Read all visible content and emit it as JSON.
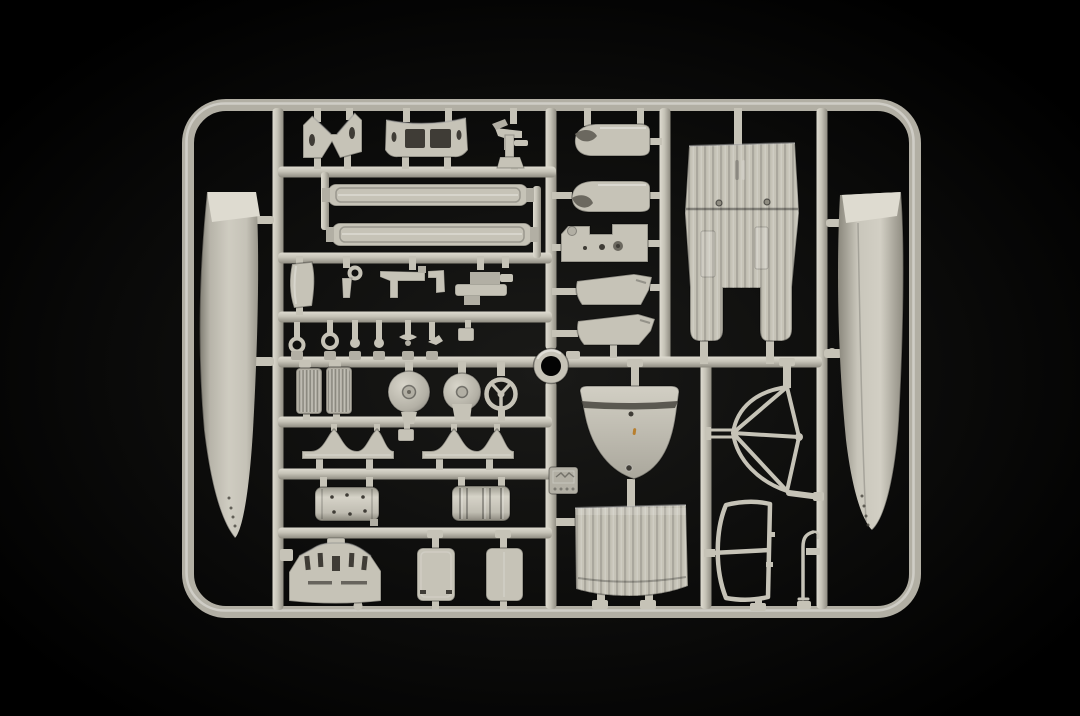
{
  "scene": {
    "media": "photograph",
    "subject": "injection-moulded model kit sprue of light grey aircraft parts on a black studio background"
  },
  "colors": {
    "background": "#000000",
    "glow": "#1a1a18",
    "plastic_base": "#c6c3b7",
    "plastic_light": "#dedbd0",
    "plastic_mid": "#b2afa4",
    "plastic_dark": "#8f8c81",
    "plastic_deep": "#6b685f",
    "recess": "#3f3c36",
    "speck_orange": "#b87f2e"
  },
  "parts": [
    {
      "name": "sprue-frame-runner"
    },
    {
      "name": "runner-ring"
    },
    {
      "name": "left-float-half"
    },
    {
      "name": "right-float-half"
    },
    {
      "name": "v-strut-support-bracket"
    },
    {
      "name": "windowed-cabin-bulkhead"
    },
    {
      "name": "machine-gun-pedestal"
    },
    {
      "name": "wing-spar-upper"
    },
    {
      "name": "wing-spar-lower"
    },
    {
      "name": "curved-fairing-sheet"
    },
    {
      "name": "hook-bracket"
    },
    {
      "name": "gun-with-mount"
    },
    {
      "name": "linkage-assembly"
    },
    {
      "name": "eyelet-pin-left"
    },
    {
      "name": "eyelet-pin-right"
    },
    {
      "name": "ball-pin-left"
    },
    {
      "name": "ball-pin-right"
    },
    {
      "name": "mini-propeller-pin"
    },
    {
      "name": "hook-pin"
    },
    {
      "name": "hanging-tab"
    },
    {
      "name": "radiator-grille-left"
    },
    {
      "name": "radiator-grille-right"
    },
    {
      "name": "wheel-disc-large"
    },
    {
      "name": "wheel-disc-small"
    },
    {
      "name": "control-yoke"
    },
    {
      "name": "cowling-half-upper"
    },
    {
      "name": "cowling-half-lower"
    },
    {
      "name": "notched-mounting-plate"
    },
    {
      "name": "equipment-panel-upper"
    },
    {
      "name": "equipment-panel-lower"
    },
    {
      "name": "corrugated-fuselage-belly"
    },
    {
      "name": "tail-cone-shield-panel"
    },
    {
      "name": "mold-logo-stamp"
    },
    {
      "name": "corrugated-hatch-panel"
    },
    {
      "name": "engine-cradle-left"
    },
    {
      "name": "engine-cradle-right"
    },
    {
      "name": "small-square-tab"
    },
    {
      "name": "smooth-tank-cylinder"
    },
    {
      "name": "ribbed-tank-cylinder"
    },
    {
      "name": "slotted-firewall-bulkhead"
    },
    {
      "name": "cabin-door-left"
    },
    {
      "name": "cabin-door-right"
    },
    {
      "name": "braced-windscreen-frame"
    },
    {
      "name": "cabin-window-frame"
    },
    {
      "name": "exhaust-pipe-rod"
    }
  ]
}
